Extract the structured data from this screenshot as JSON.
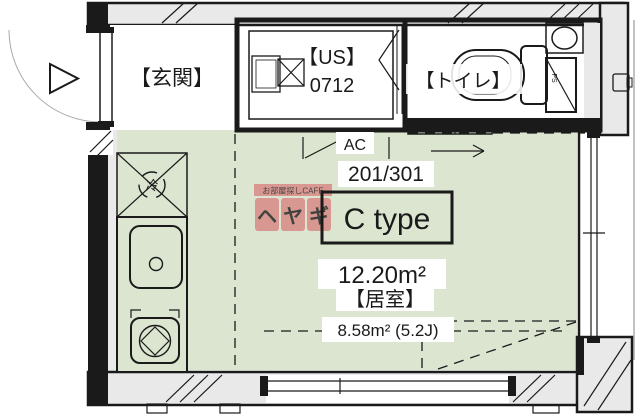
{
  "labels": {
    "entrance": "【玄関】",
    "unit_bath_line1": "【US】",
    "unit_bath_line2": "0712",
    "toilet": "【トイレ】",
    "ac": "AC",
    "pipe_space": "PS",
    "refrigerator": "冷",
    "unit_numbers": "201/301",
    "plan_type": "C type",
    "total_area": "12.20m²",
    "room_name": "【居室】",
    "room_area": "8.58m² (5.2J)"
  },
  "watermark": {
    "tagline": "お部屋探しCAFE",
    "chars": [
      "ヘ",
      "ヤ",
      "ギ"
    ]
  },
  "colors": {
    "floor": "#dbe5cf",
    "wall": "#e9e9e9",
    "line": "#1a1a1a",
    "watermark": "#d98484",
    "white": "#ffffff"
  }
}
